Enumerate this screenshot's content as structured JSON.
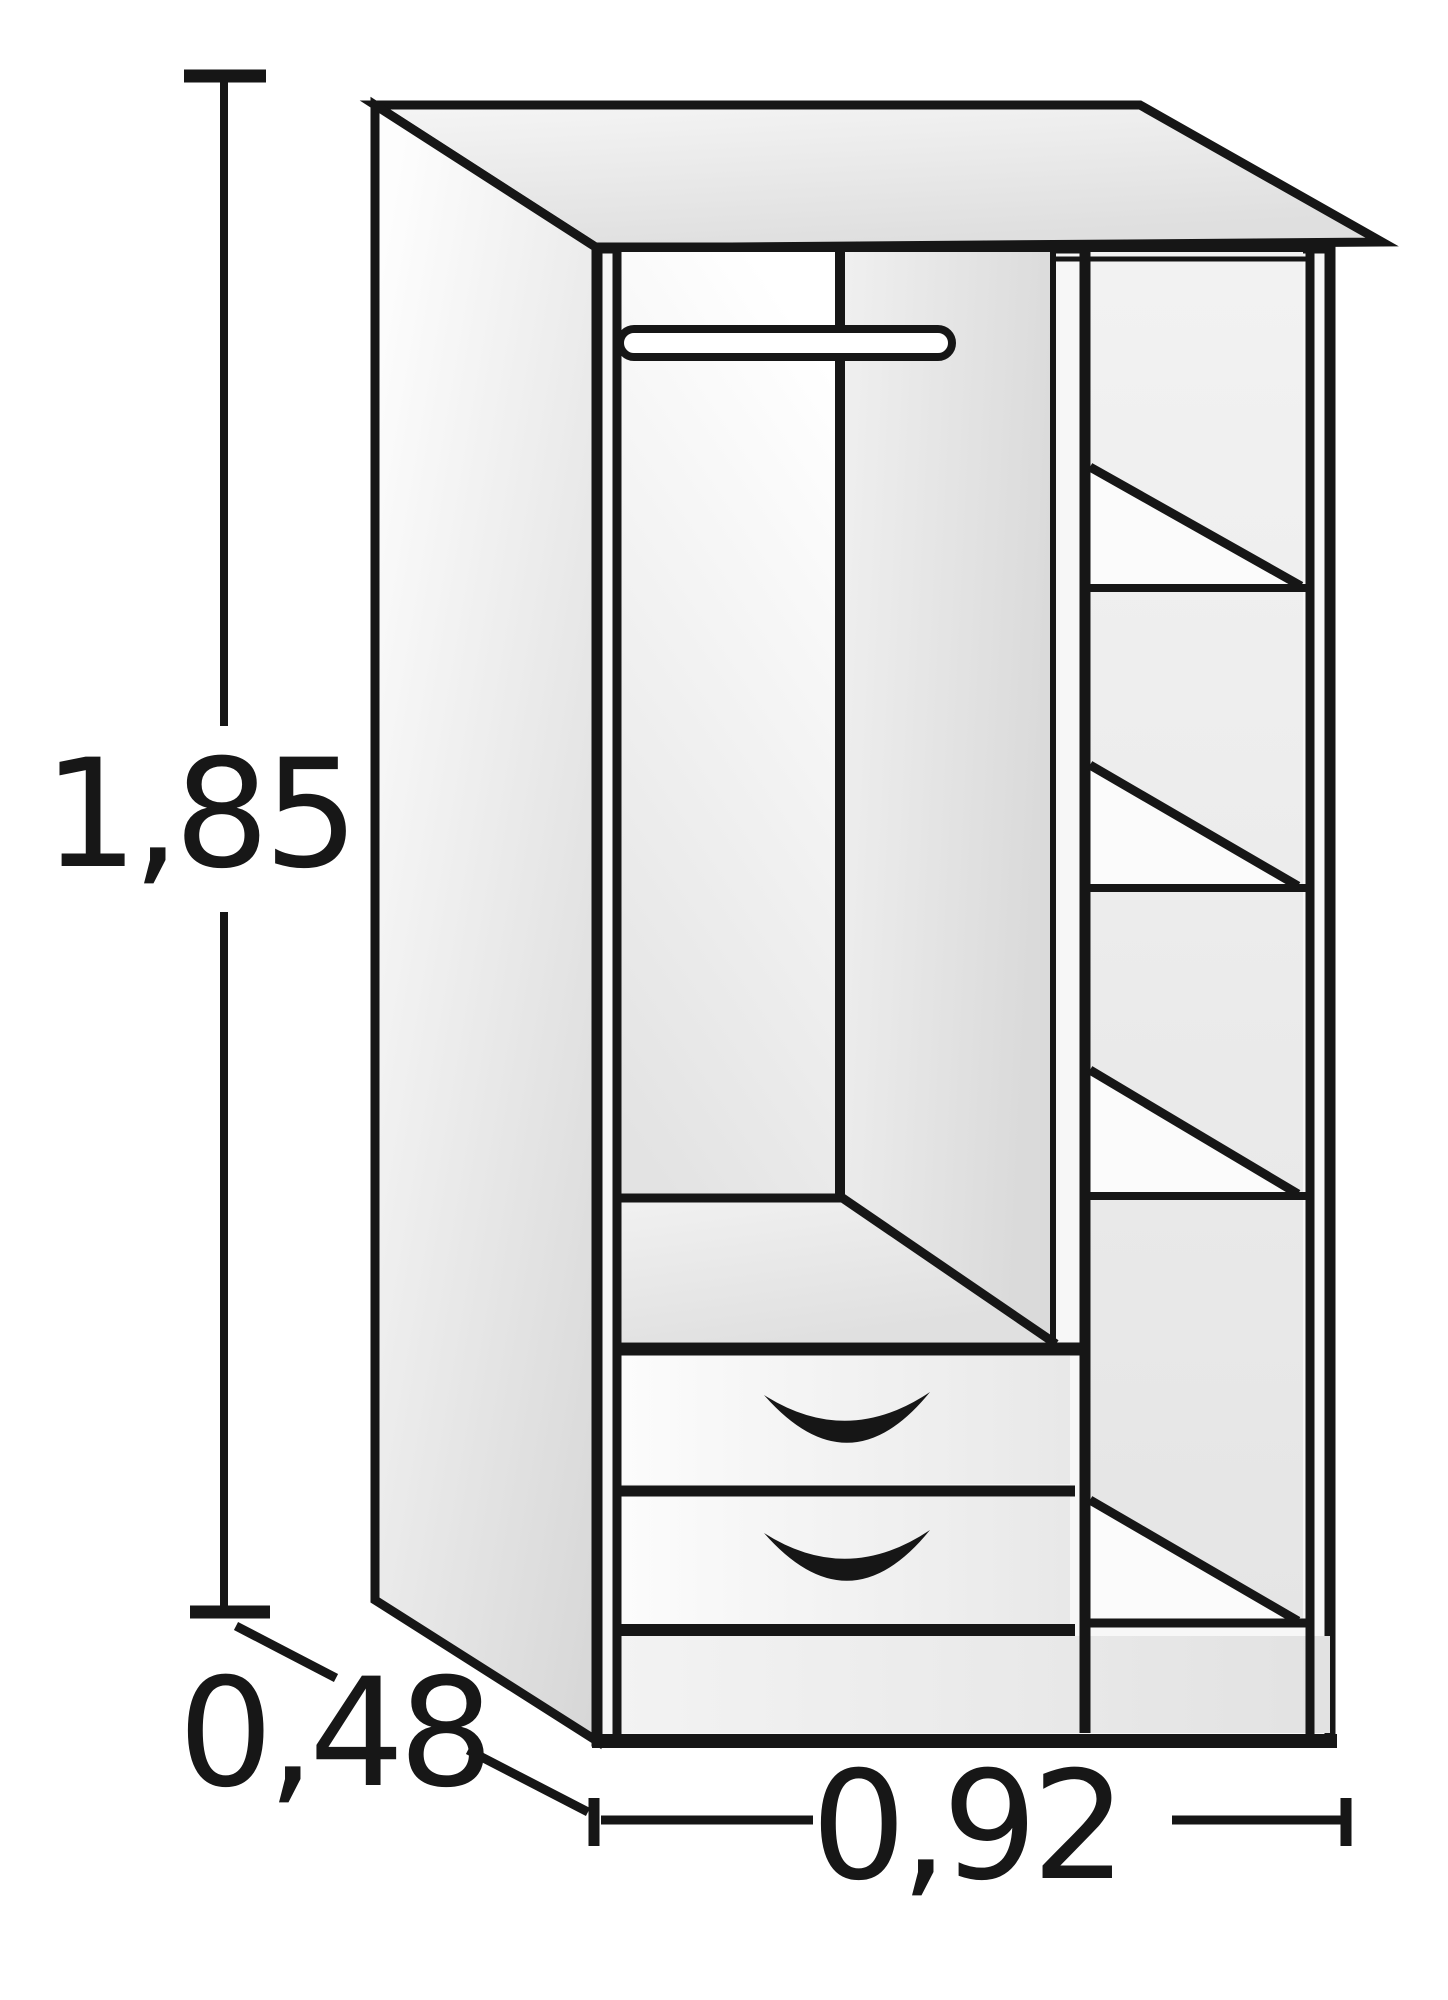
{
  "diagram": {
    "type": "furniture-dimension-drawing",
    "subject": "wardrobe-line-drawing",
    "dimension_labels": {
      "height": "1,85",
      "depth": "0,48",
      "width": "0,92"
    },
    "features": {
      "hanging_rail": true,
      "side_shelves": 4,
      "drawers": 2
    }
  },
  "colors": {
    "line": "#161616",
    "background": "#ffffff",
    "shade_light": "#f6f6f6",
    "shade_dark": "#dcdcdc"
  }
}
